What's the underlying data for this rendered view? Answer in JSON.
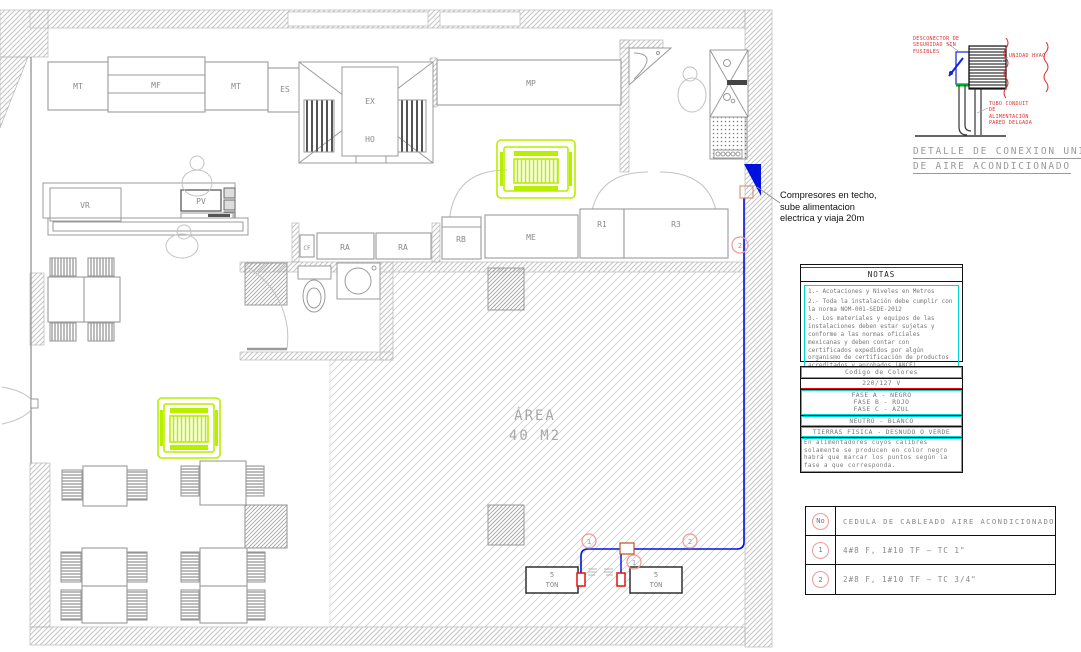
{
  "plan": {
    "equipment_labels": {
      "mt1": "MT",
      "mf": "MF",
      "mt2": "MT",
      "es": "ES",
      "ex": "EX",
      "ho": "HO",
      "mp": "MP",
      "vr": "VR",
      "pv": "PV",
      "cf": "CF",
      "ra1": "RA",
      "ra2": "RA",
      "rb": "RB",
      "me": "ME",
      "r1": "R1",
      "r3": "R3"
    },
    "area_line1": "ÁREA",
    "area_line2": "40 M2",
    "unit1_line1": "5",
    "unit1_line2": "TON",
    "unit2_line1": "5",
    "unit2_line2": "TON",
    "keynote_1a": "1",
    "keynote_1b": "1",
    "keynote_2a": "2",
    "keynote_2b": "2",
    "compressor_note": "Compresores en techo, sube alimentacion electrica y viaja 20m"
  },
  "detail": {
    "label_disconnector": "DESCONECTOR DE SEGURIDAD SIN FUSIBLES",
    "label_unit": "UNIDAD HVAC",
    "label_conduit": "TUBO CONDUIT DE ALIMENTACIÓN PARED DELGADA",
    "title_line1": "DETALLE DE CONEXION UNIDAD",
    "title_line2": "DE AIRE ACONDICIONADO"
  },
  "notes": {
    "title": "NOTAS",
    "items": [
      "1.- Acotaciones y Niveles en Metros",
      "2.- Toda la instalación debe cumplir con la norma NOM-001-SEDE-2012",
      "3.- Los materiales y equipos de las instalaciones deben estar sujetas y conforme a las normas oficiales mexicanas y deben contar con certificados expedidos por algún organismo de certificación de productos acreditados y aprobados (ANCE).",
      "4.- Todas las uniones y conexiones deben de ser realizadas con capuchon resorte o soldadas."
    ]
  },
  "color_code": {
    "title": "Codigo de Colores",
    "voltage": "220/127 V",
    "phase_a": "FASE A - NEGRO",
    "phase_b": "FASE B - ROJO",
    "phase_c": "FASE C - AZUL",
    "neutral": "NEUTRO - BLANCO",
    "ground": "TIERRAS FISICA - DESNUDO O VERDE",
    "note": "En alimentadores cuyos calibres solamente se producen en color negro habrá que marcar los puntos según la fase a que corresponda."
  },
  "schedule": {
    "header_no": "No",
    "header_title": "CEDULA DE CABLEADO AIRE ACONDICIONADO",
    "rows": [
      {
        "no": "1",
        "spec": "4#8 F, 1#10 TF – TC 1\""
      },
      {
        "no": "2",
        "spec": "2#8 F, 1#10 TF – TC 3/4\""
      }
    ]
  },
  "colors": {
    "wire_blue": "#0011dd",
    "cassette_green": "#b8ef00",
    "accent_red": "#ff0000",
    "accent_cyan": "#00d5d5"
  }
}
